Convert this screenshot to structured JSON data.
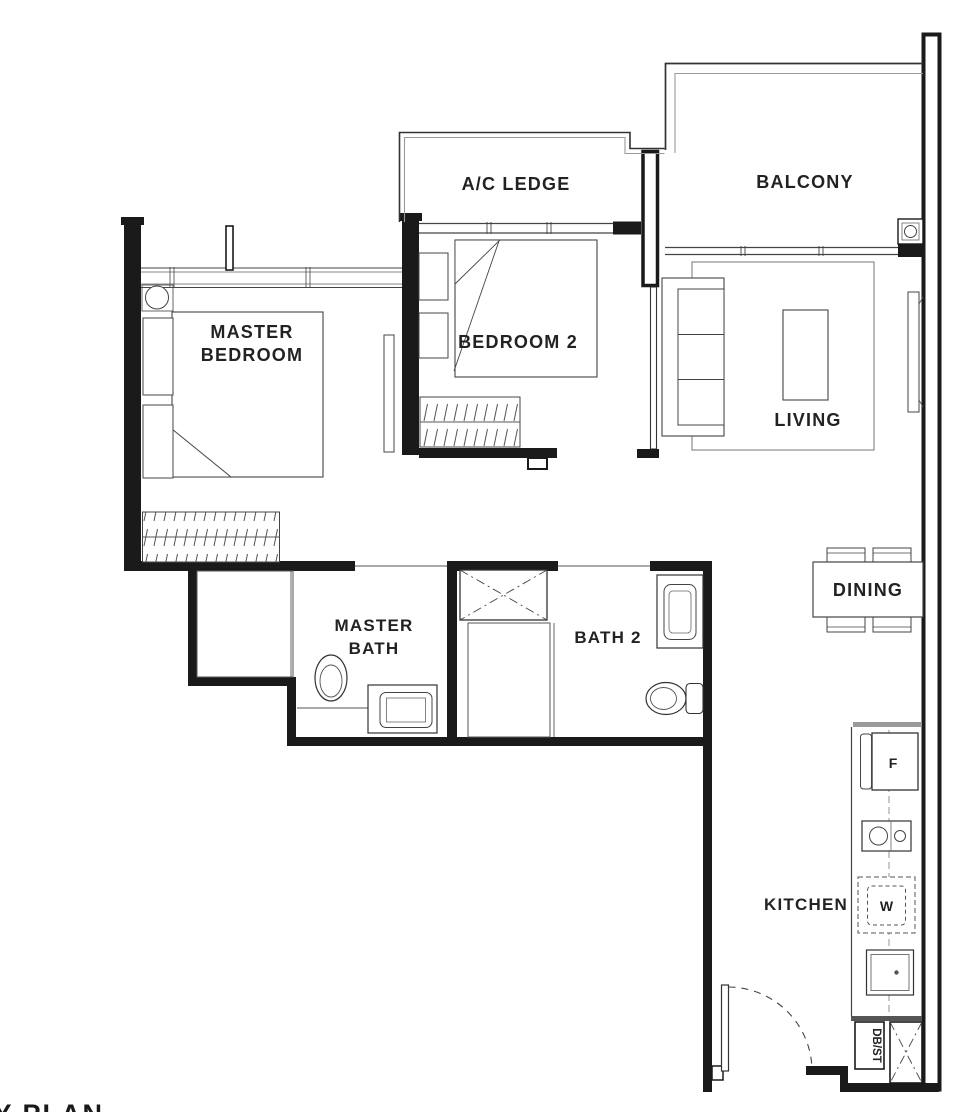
{
  "title": "2-bedroom unit floor plan",
  "colors": {
    "wall": "#1a1a1a",
    "line": "#3f3f3f",
    "line_light": "#8a8a8a",
    "counter_gray": "#9a9a9a",
    "text": "#1f1f1f",
    "background": "#ffffff"
  },
  "rooms": {
    "ac_ledge": {
      "label": "A/C LEDGE"
    },
    "balcony": {
      "label": "BALCONY"
    },
    "master_bedroom": {
      "label_line1": "MASTER",
      "label_line2": "BEDROOM"
    },
    "bedroom2": {
      "label": "BEDROOM 2"
    },
    "living": {
      "label": "LIVING"
    },
    "dining": {
      "label": "DINING"
    },
    "master_bath": {
      "label_line1": "MASTER",
      "label_line2": "BATH"
    },
    "bath2": {
      "label": "BATH 2"
    },
    "kitchen": {
      "label": "KITCHEN"
    }
  },
  "appliances": {
    "fridge": "F",
    "washer": "W",
    "db_st": "DB/ST"
  },
  "footer": {
    "key_plan": "KEY PLAN"
  }
}
